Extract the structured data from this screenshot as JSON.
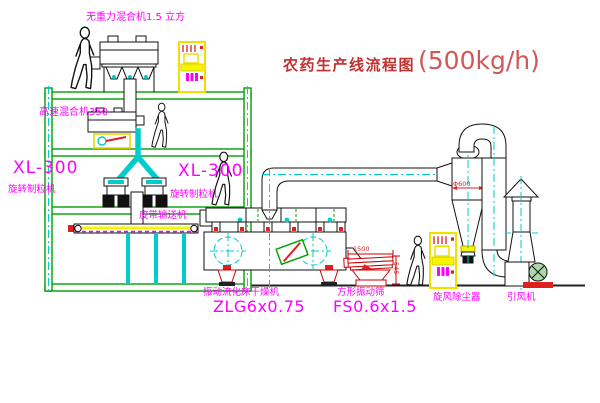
{
  "title": {
    "name": "农药生产线流程图",
    "capacity": "(500kg/h)"
  },
  "equipment_labels": {
    "gravity_free_mixer": "无重力混合机1.5 立方",
    "high_speed_mixer": "高速混合机350",
    "granulator_left_model": "XL-300",
    "granulator_left_name": "旋转制粒机",
    "granulator_center_model": "XL-300",
    "granulator_center_name": "旋转制粒机",
    "belt_conveyor": "皮带输送机",
    "fluid_bed_dryer_name": "振动流化床干燥机",
    "fluid_bed_dryer_model": "ZLG6x0.75",
    "square_vibrating_sieve_name": "方形振动筛",
    "square_vibrating_sieve_model": "FS0.6x1.5",
    "cyclone_dust_collector": "旋风除尘器",
    "induced_draft_fan": "引风机"
  },
  "dimensions": {
    "sieve_length": "1500",
    "sieve_height": "545",
    "cyclone_diameter": "Φ600"
  },
  "colors": {
    "label_magenta": "#FF00FF",
    "title_red": "#C23030",
    "structure_green": "#00A000",
    "centerline_cyan": "#00CCCC",
    "machine_red": "#E02020",
    "cabinet_yellow": "#F0F000"
  }
}
